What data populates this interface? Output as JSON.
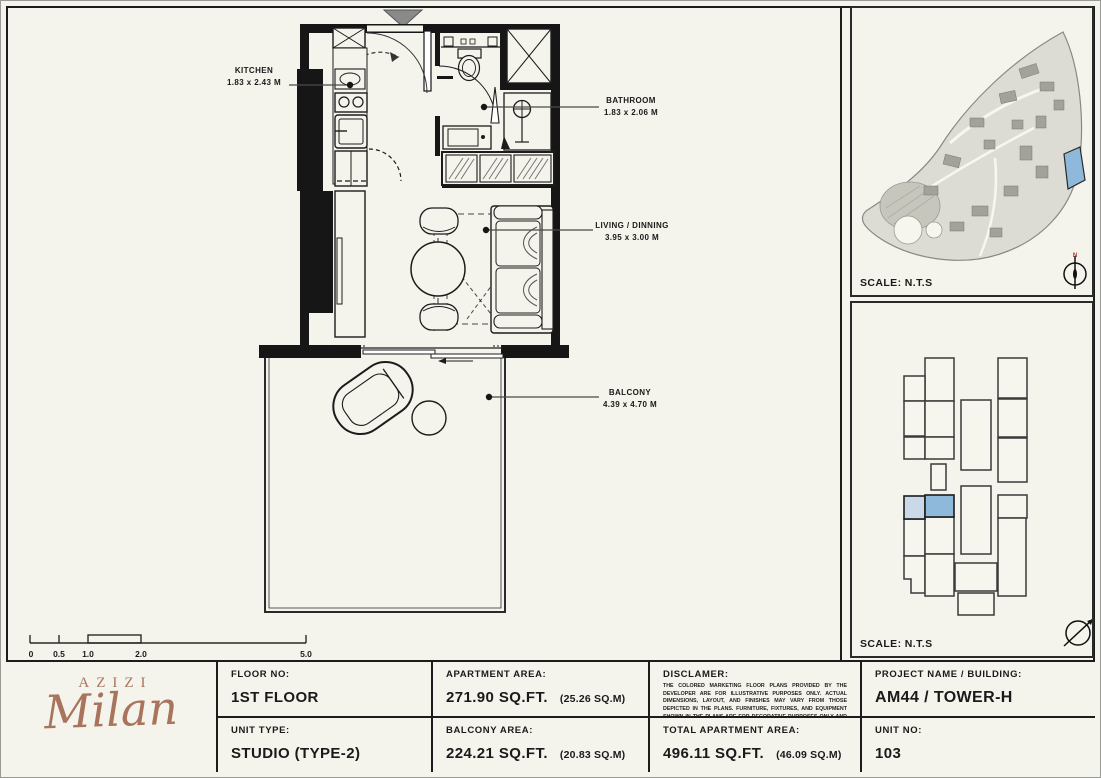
{
  "floor_plan": {
    "rooms": {
      "kitchen": {
        "name": "KITCHEN",
        "dims": "1.83 x 2.43 M"
      },
      "bathroom": {
        "name": "BATHROOM",
        "dims": "1.83 x 2.06 M"
      },
      "living": {
        "name": "LIVING / DINNING",
        "dims": "3.95 x 3.00 M"
      },
      "balcony": {
        "name": "BALCONY",
        "dims": "4.39 x 4.70 M"
      }
    },
    "scale_bar": {
      "ticks": [
        "0",
        "0.5",
        "1.0",
        "2.0",
        "5.0"
      ]
    }
  },
  "panels": {
    "site": {
      "scale_label": "SCALE: N.T.S",
      "compass_n": "N",
      "highlight_color": "#8fb9da"
    },
    "key": {
      "scale_label": "SCALE: N.T.S",
      "highlight_light": "#c9d9e8",
      "highlight_dark": "#8fb9da"
    }
  },
  "footer": {
    "logo": {
      "brand": "AZIZI",
      "name": "Milan",
      "color": "#a8745c"
    },
    "floor_no_label": "FLOOR NO:",
    "floor_no": "1ST FLOOR",
    "unit_type_label": "UNIT TYPE:",
    "unit_type": "STUDIO (TYPE-2)",
    "apartment_area_label": "APARTMENT AREA:",
    "apartment_area": "271.90 SQ.FT.",
    "apartment_area_m": "(25.26 SQ.M)",
    "balcony_area_label": "BALCONY AREA:",
    "balcony_area": "224.21 SQ.FT.",
    "balcony_area_m": "(20.83 SQ.M)",
    "disclaimer_label": "DISCLAMER:",
    "disclaimer_text": "THE COLORED MARKETING FLOOR PLANS PROVIDED BY THE DEVELOPER ARE FOR ILLUSTRATIVE PURPOSES ONLY. ACTUAL DIMENSIONS, LAYOUT, AND FINISHES MAY VARY FROM THOSE DEPICTED IN THE PLANS. FURNITURE, FIXTURES, AND EQUIPMENT SHOWN IN THE PLANS ARE FOR DECORATIVE PURPOSES ONLY AND ARE NOT INCLUDED IN THE PURCHASE OR LEASE OF THE PROPERTY. THE DEVELOPER RESERVES THE RIGHT TO MAKE MODIFICATIONS, REVISIONS, AND CHANGES TO THE FLOOR PLANS, SPECIFICATIONS, AND FEATURES WITHOUT PRIOR NOTICE.",
    "total_area_label": "TOTAL APARTMENT AREA:",
    "total_area": "496.11 SQ.FT.",
    "total_area_m": "(46.09 SQ.M)",
    "project_label": "PROJECT NAME / BUILDING:",
    "project": "AM44 / TOWER-H",
    "unit_no_label": "UNIT NO:",
    "unit_no": "103"
  }
}
